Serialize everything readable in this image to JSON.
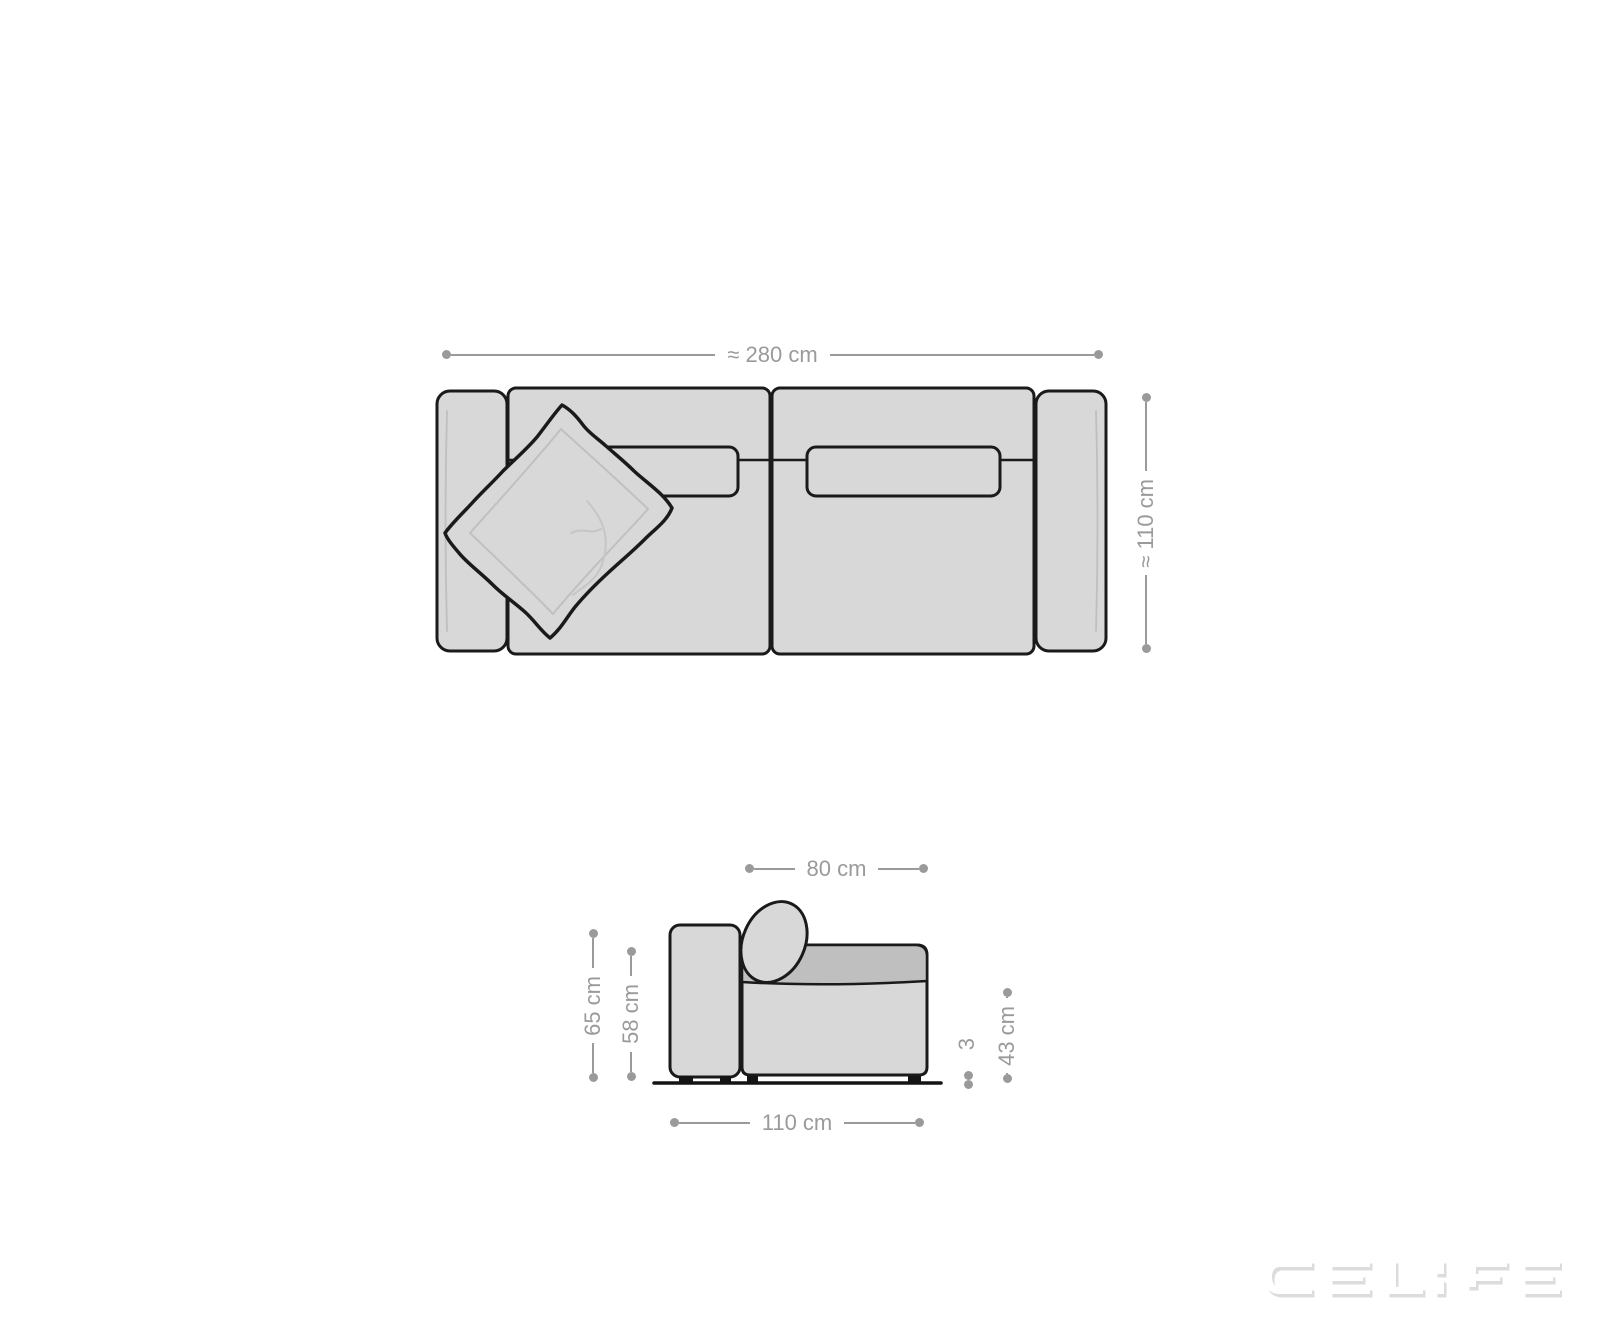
{
  "title": "Sofa dimensions diagram",
  "colors": {
    "background": "#ffffff",
    "outline": "#1a1a1a",
    "fill": "#d8d8d8",
    "fill_dark": "#bfbfbf",
    "sketch": "#c0c0c0",
    "dimension": "#9a9a9a",
    "watermark_shadow": "#dcdcdc"
  },
  "dimensions": {
    "top_width": "≈ 280 cm",
    "top_depth": "≈ 110 cm",
    "seat_depth": "80 cm",
    "total_height": "65 cm",
    "back_height": "58 cm",
    "seat_height": "43 cm",
    "foot_height": "3",
    "total_depth": "110 cm"
  },
  "watermark": {
    "text": "DELIFE"
  }
}
